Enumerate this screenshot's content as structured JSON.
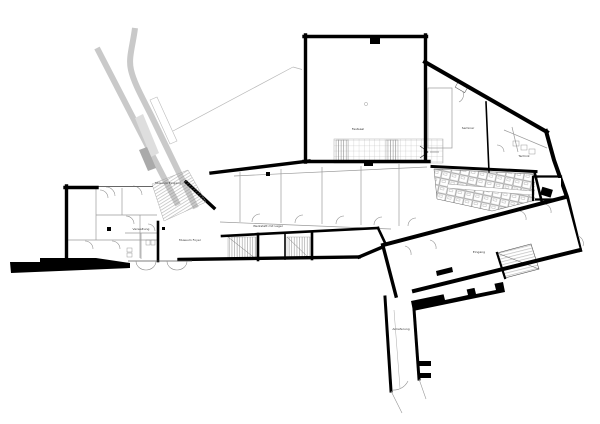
{
  "colors": {
    "background": "#ffffff",
    "wall": "#000000",
    "partition": "#9a9a9a",
    "ramp": "#c9c9c9",
    "ramp_light": "#dedede",
    "ramp_dark": "#aaaaaa",
    "site_line": "#b8b8b8",
    "label": "#333333"
  },
  "plan": {
    "labels": [
      {
        "id": "hall-upper",
        "text": "Festsaal",
        "x": 358,
        "y": 130
      },
      {
        "id": "entrance",
        "text": "Museum Eingang",
        "x": 168,
        "y": 184
      },
      {
        "id": "foyer",
        "text": "Museum Foyer",
        "x": 190,
        "y": 241
      },
      {
        "id": "workshop",
        "text": "Werkstatt mit Lager",
        "x": 268,
        "y": 227
      },
      {
        "id": "seminar",
        "text": "Seminar",
        "x": 468,
        "y": 129
      },
      {
        "id": "technik",
        "text": "Technik",
        "x": 524,
        "y": 157
      },
      {
        "id": "hall-lower",
        "text": "Eingang",
        "x": 479,
        "y": 253
      },
      {
        "id": "left-wing",
        "text": "Verwaltung",
        "x": 141,
        "y": 230
      },
      {
        "id": "corridor",
        "text": "Anlieferung",
        "x": 401,
        "y": 330
      }
    ]
  }
}
